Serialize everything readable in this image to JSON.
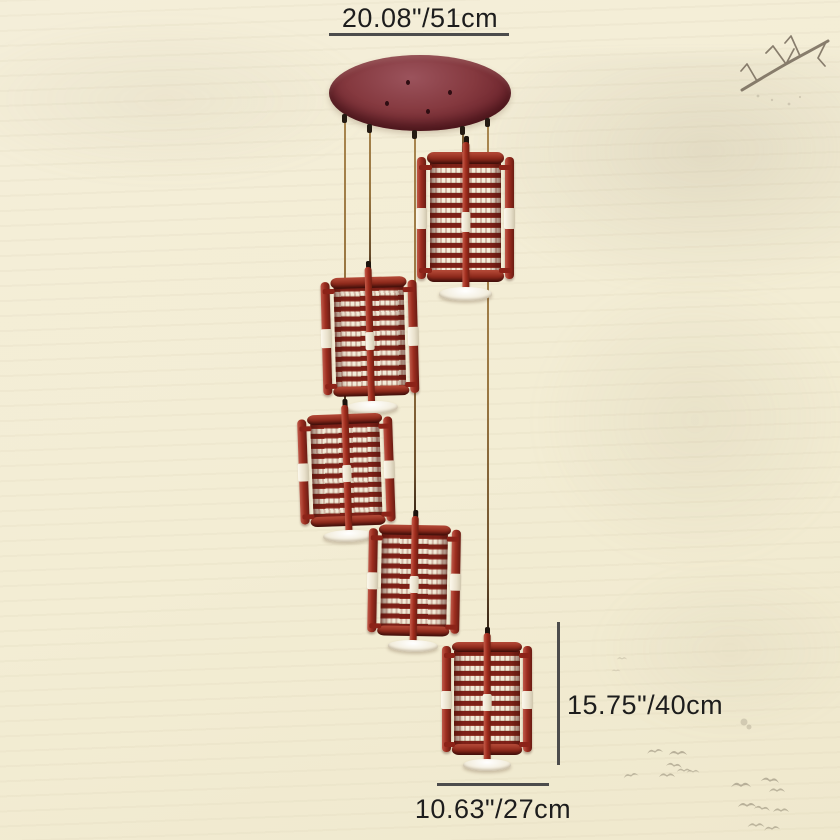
{
  "dimensions": {
    "width_label": "20.08\"/51cm",
    "drop_label": "15.75\"/40cm",
    "shade_label": "10.63\"/27cm"
  },
  "fixture": {
    "lantern_count": 5,
    "cord_count": 5
  },
  "colors": {
    "background": "#f3edd4",
    "canopy": "#85393f",
    "lantern_wood_red": "#9c2d1f",
    "lantern_shade_cream": "#f3ecd9",
    "accent_band": "#fcf8ec",
    "cord_gold": "#9a7742",
    "annotation_line": "#4c4c4c",
    "annotation_text": "#1d1d1d",
    "ink_wash": "#6e6253",
    "birds": "#a59c87"
  }
}
